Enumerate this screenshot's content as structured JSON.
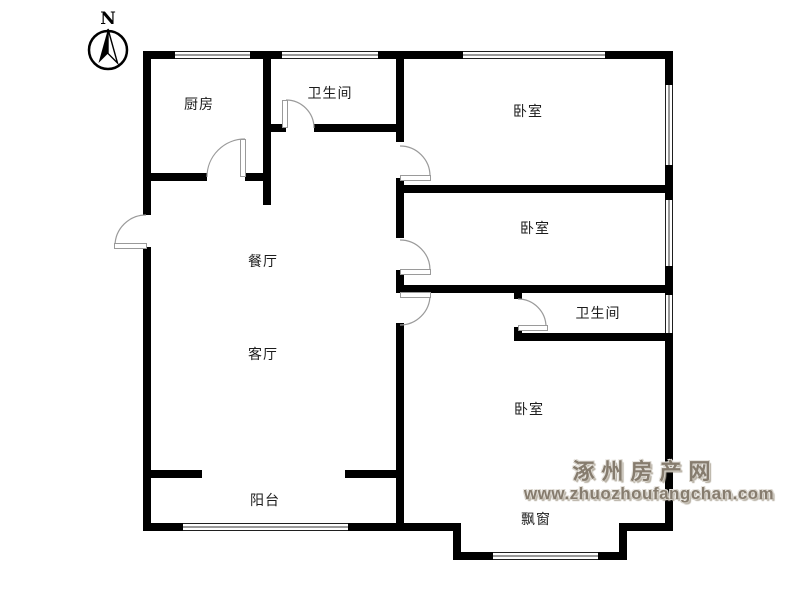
{
  "compass": {
    "north_label": "N"
  },
  "rooms": [
    {
      "name": "kitchen",
      "label": "厨房"
    },
    {
      "name": "bathroom-1",
      "label": "卫生间"
    },
    {
      "name": "bedroom-1",
      "label": "卧室"
    },
    {
      "name": "bedroom-2",
      "label": "卧室"
    },
    {
      "name": "bathroom-2",
      "label": "卫生间"
    },
    {
      "name": "bedroom-3",
      "label": "卧室"
    },
    {
      "name": "dining-room",
      "label": "餐厅"
    },
    {
      "name": "living-room",
      "label": "客厅"
    },
    {
      "name": "balcony",
      "label": "阳台"
    },
    {
      "name": "bay-window",
      "label": "飘窗"
    }
  ],
  "watermark": {
    "site_name": "涿州房产网",
    "site_url": "www.zhuozhoufangchan.com",
    "color": "#867c6e"
  },
  "colors": {
    "wall": "#000000",
    "door_arc": "#9a9a9a",
    "text": "#1c1c1c"
  }
}
